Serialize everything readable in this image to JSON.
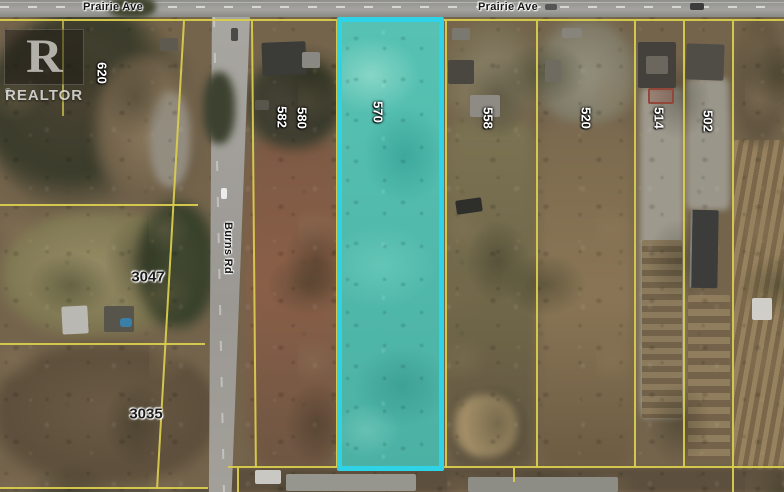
{
  "map": {
    "watermark": {
      "logo_letter": "R",
      "brand_text": "REALTOR",
      "registered_mark": "®"
    },
    "roads": {
      "prairie_ave_left": "Prairie Ave",
      "prairie_ave_right": "Prairie Ave",
      "burns_rd": "Burns Rd"
    },
    "highlighted_parcel": {
      "number": "570",
      "border_color": "#2fd3e8",
      "fill_color": "#4fbcae"
    },
    "parcels": {
      "p620": "620",
      "p582": "582",
      "p580": "580",
      "p558": "558",
      "p520": "520",
      "p514": "514",
      "p502": "502",
      "p3047": "3047",
      "p3035": "3035"
    },
    "colors": {
      "boundary_line": "#d9cc4e",
      "road_gray": "#9b9893"
    }
  }
}
